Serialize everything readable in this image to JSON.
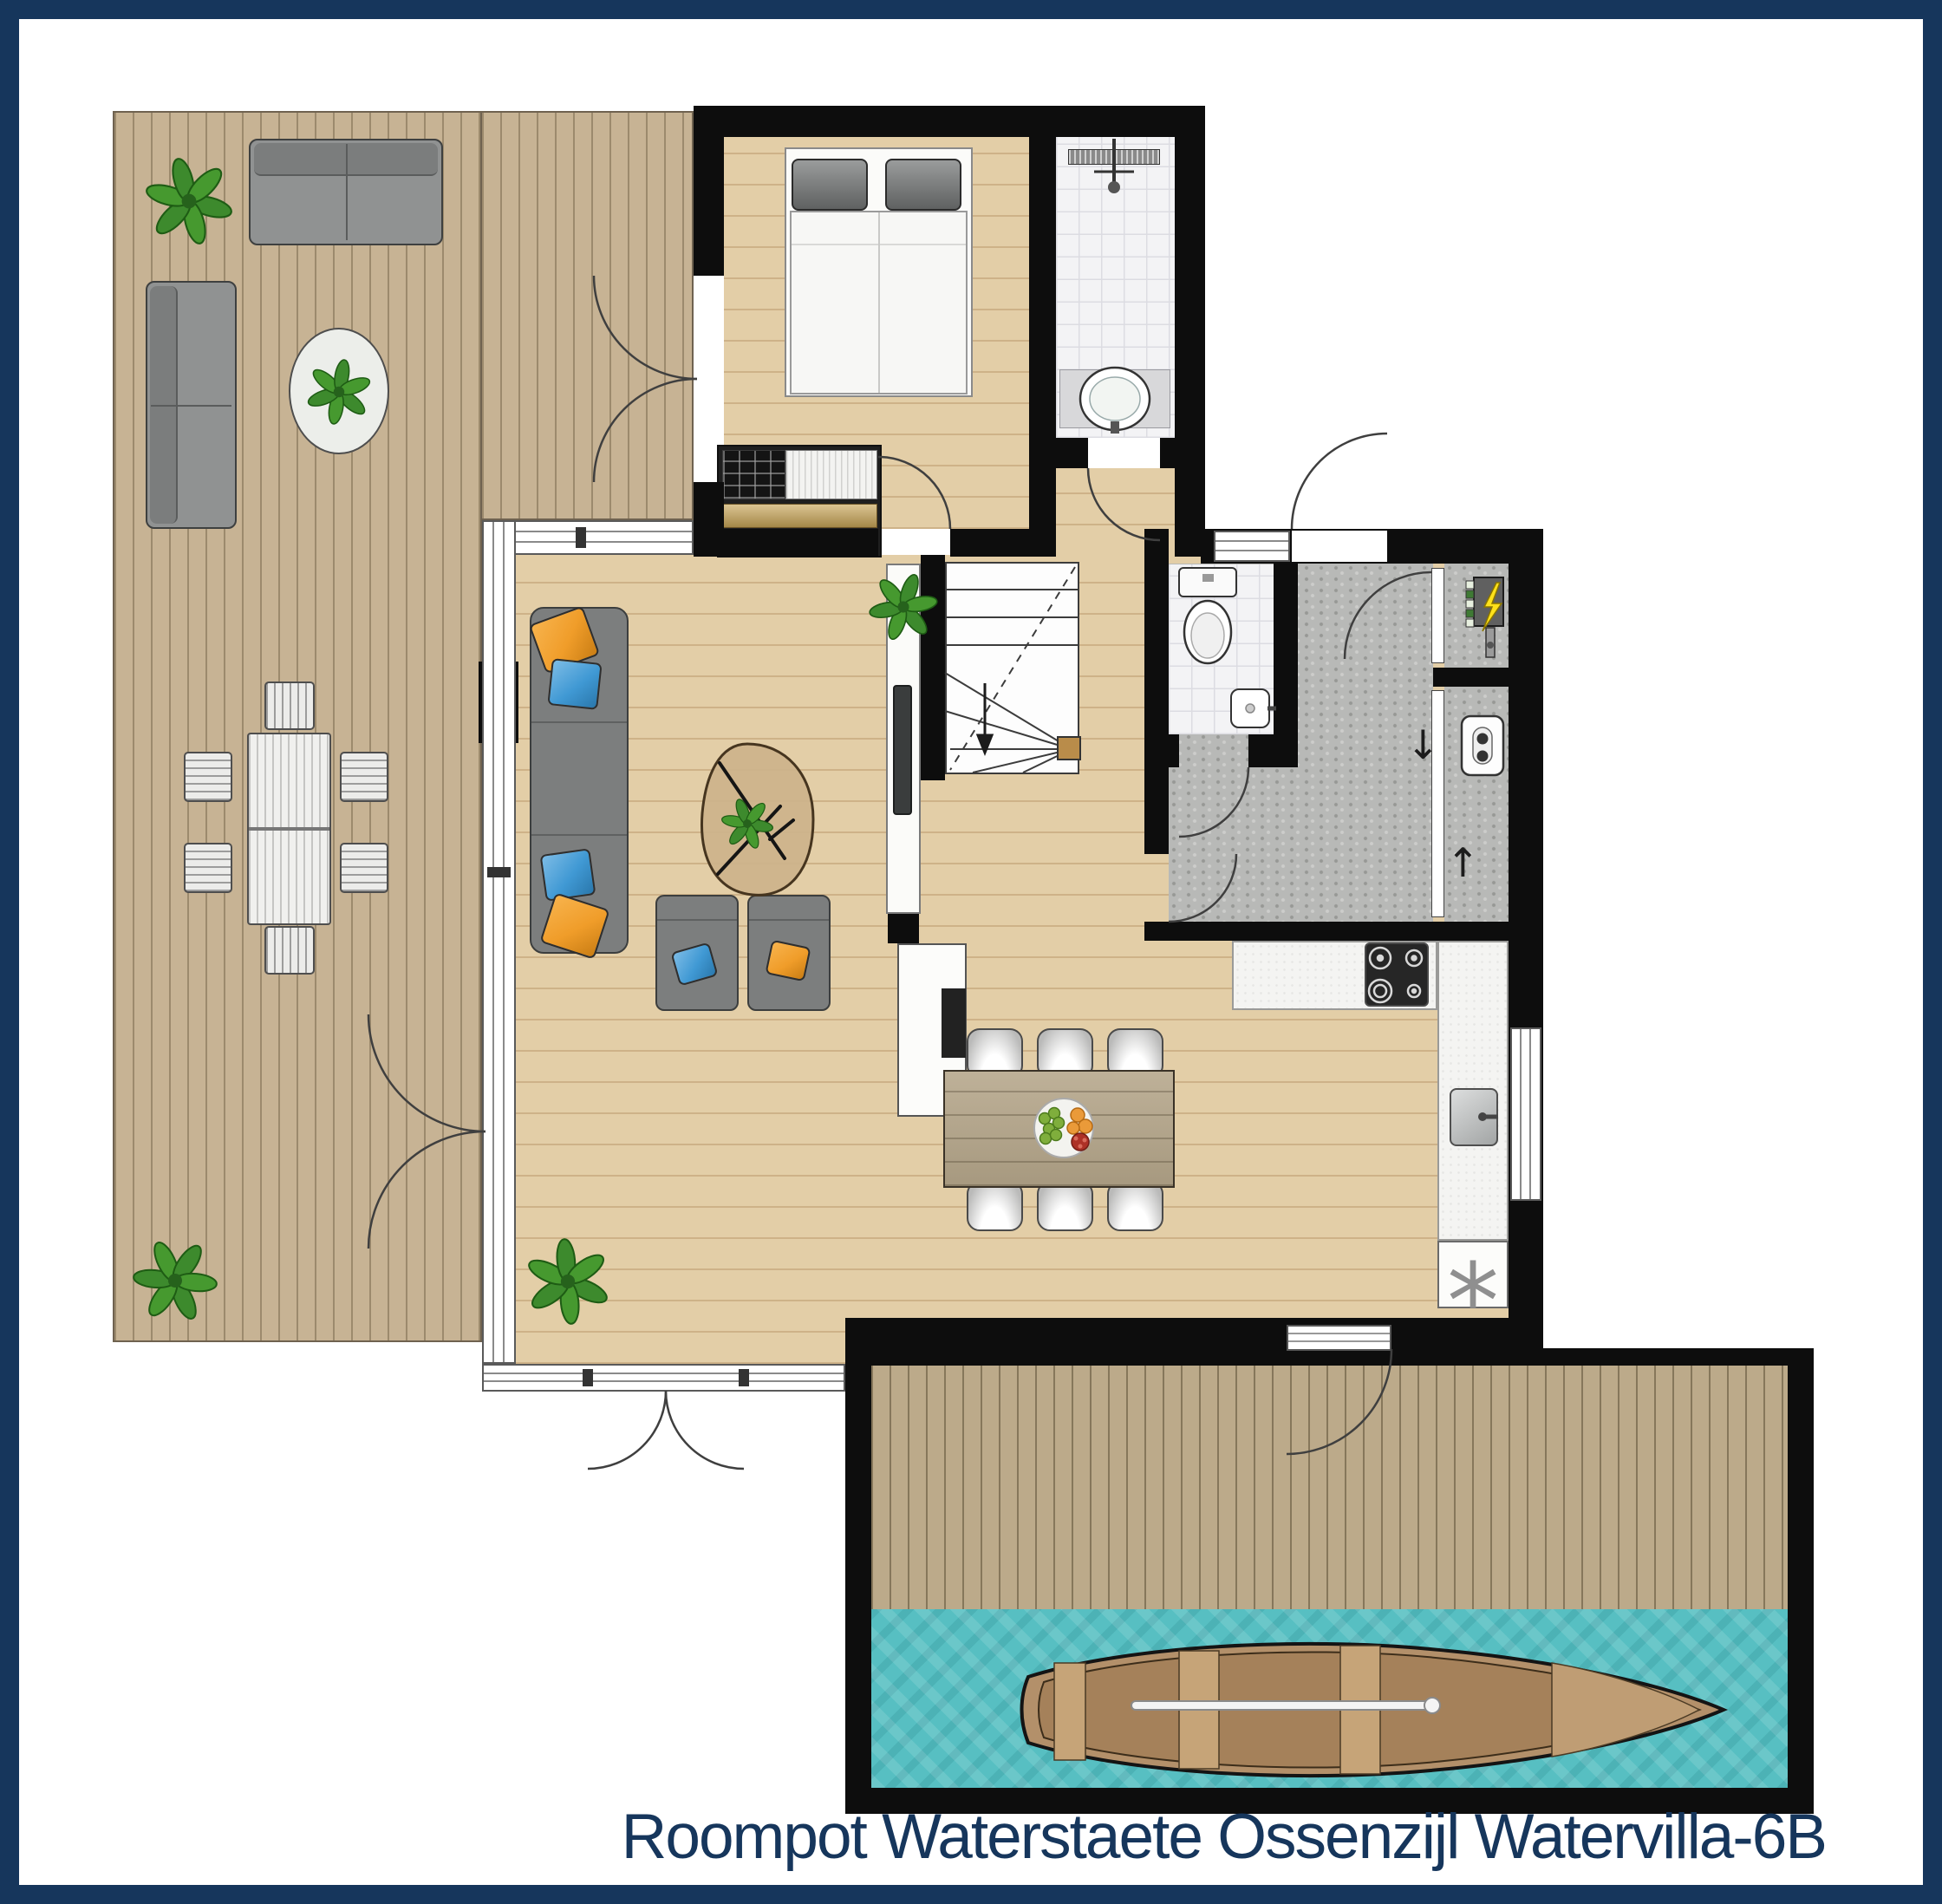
{
  "caption": {
    "text": "Roompot Waterstaete Ossenzijl Watervilla-6B"
  },
  "symbols": {
    "dishwasher": "*",
    "arrow_down": "↓",
    "arrow_up": "↑"
  },
  "colors": {
    "frame_navy": "#16365C",
    "caption_text": "#16365C",
    "wall": "#0D0D0D",
    "deck_wood": "#C7B394",
    "interior_floor": "#E3CEA7",
    "dock_wood": "#BCAA8A",
    "water": "#57BFC2",
    "bathroom_tile": "#F3F3F5",
    "utility_gray": "#B8B9B7",
    "counter": "#F4F4F2",
    "furniture_gray": "#7C7E7E",
    "outdoor_gray": "#909292",
    "pillow_orange": "#F09D2A",
    "pillow_blue": "#4099D4",
    "plant_green": "#3D8A2D",
    "table_wood": "#B5A68A",
    "drawer_tan": "#C8A558",
    "boat_hull": "#B3906A"
  }
}
